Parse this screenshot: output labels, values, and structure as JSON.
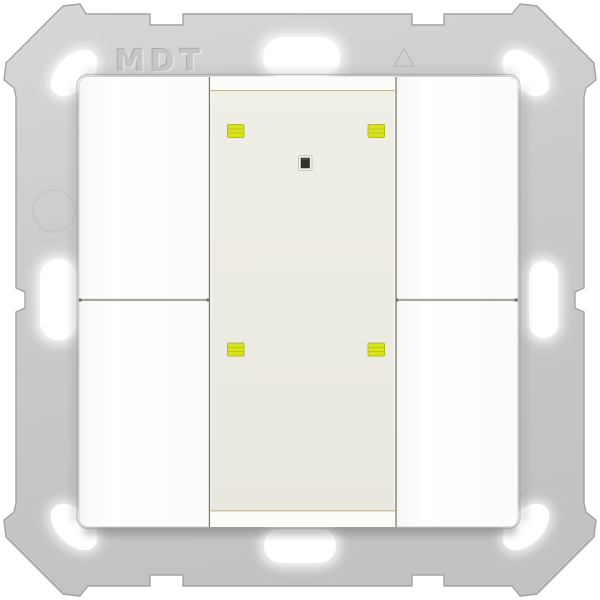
{
  "image_type": "product-photo",
  "device": {
    "embossed_brand": "MDT",
    "kind": "wall-push-button-4-fold",
    "frame": {
      "color": "#cbcbcb",
      "edge_color": "#a2a2a2"
    },
    "plate": {
      "button_color": "#fdfdfd",
      "seam_color": "#857e69"
    },
    "buttons": [
      {
        "id": "button-top-left"
      },
      {
        "id": "button-bottom-left"
      },
      {
        "id": "button-top-right"
      },
      {
        "id": "button-bottom-right"
      }
    ],
    "center_panel": {
      "color": "#edece4",
      "bevel_color": "#fcfcf8",
      "leds": [
        {
          "id": "led-top-left",
          "color": "#d9e41e"
        },
        {
          "id": "led-top-right",
          "color": "#d9e41e"
        },
        {
          "id": "led-bottom-left",
          "color": "#d9e41e"
        },
        {
          "id": "led-bottom-right",
          "color": "#d9e41e"
        }
      ],
      "sensor": {
        "id": "center-sensor",
        "color": "#34322d"
      }
    }
  }
}
